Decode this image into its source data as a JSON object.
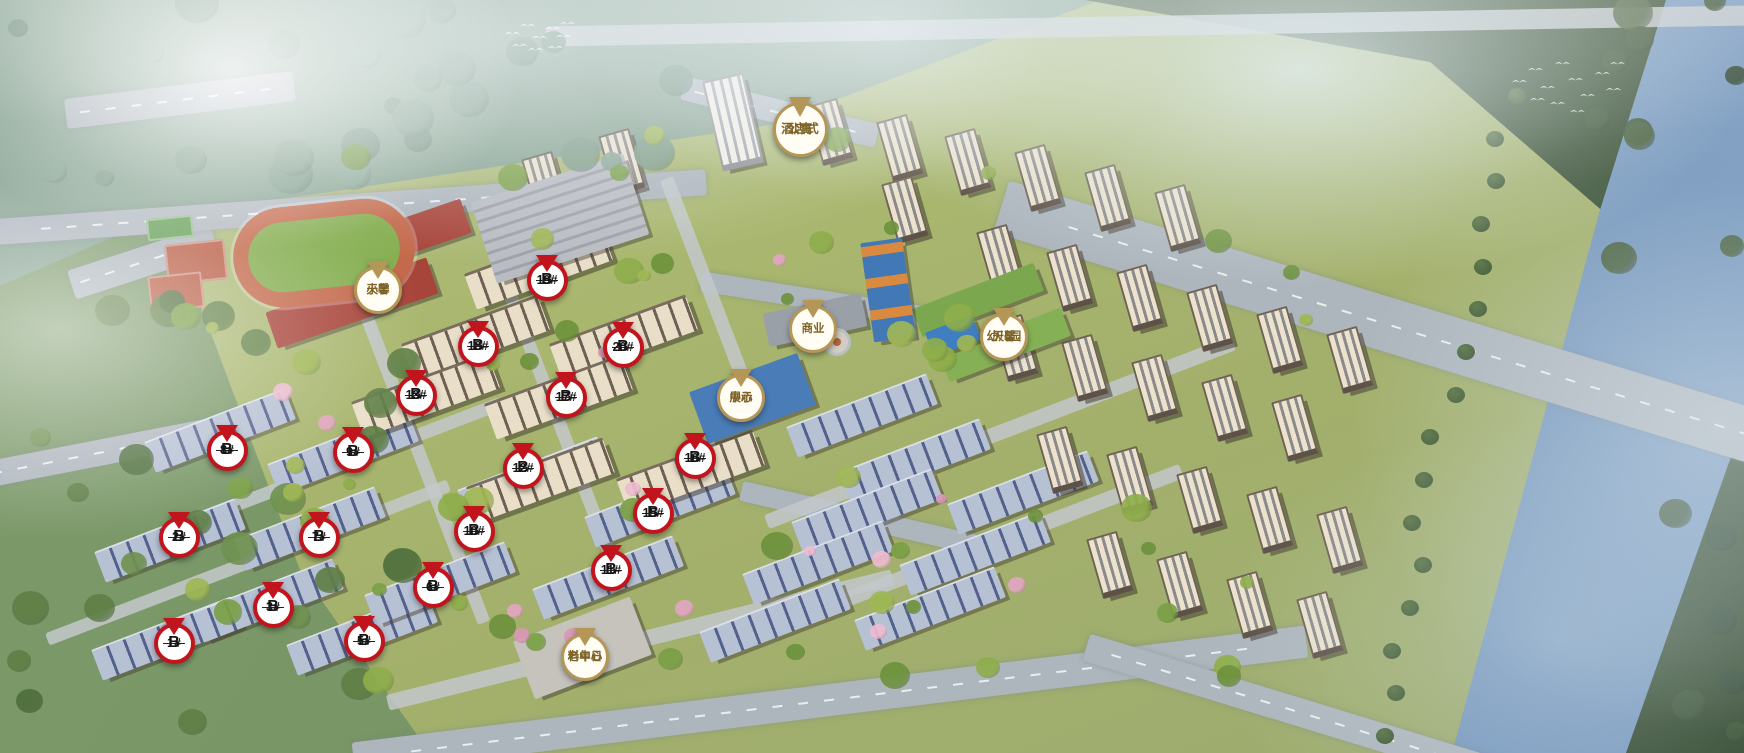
{
  "colors": {
    "pin_red": "#c1141d",
    "pin_gold": "#b49757",
    "pin_red_text": "#151515",
    "pin_gold_text": "#7d6327"
  },
  "pins": {
    "buildings": [
      {
        "slug": "b-1",
        "top": "B",
        "bottom": "1#",
        "x": 174,
        "y": 623
      },
      {
        "slug": "b-2",
        "top": "B",
        "bottom": "2#",
        "x": 179,
        "y": 517
      },
      {
        "slug": "b-3",
        "top": "B",
        "bottom": "3#",
        "x": 273,
        "y": 587
      },
      {
        "slug": "b-5",
        "top": "B",
        "bottom": "5#",
        "x": 364,
        "y": 621
      },
      {
        "slug": "b-6",
        "top": "B",
        "bottom": "6#",
        "x": 433,
        "y": 567
      },
      {
        "slug": "b-7",
        "top": "B",
        "bottom": "7#",
        "x": 319,
        "y": 517
      },
      {
        "slug": "b-8",
        "top": "B",
        "bottom": "8#",
        "x": 227,
        "y": 430
      },
      {
        "slug": "b-9",
        "top": "B",
        "bottom": "9#",
        "x": 353,
        "y": 432
      },
      {
        "slug": "b-10",
        "top": "B",
        "bottom": "10#",
        "x": 474,
        "y": 511
      },
      {
        "slug": "b-11",
        "top": "B",
        "bottom": "11#",
        "x": 611,
        "y": 550
      },
      {
        "slug": "b-12",
        "top": "B",
        "bottom": "12#",
        "x": 523,
        "y": 448
      },
      {
        "slug": "b-13",
        "top": "B",
        "bottom": "13#",
        "x": 416,
        "y": 375
      },
      {
        "slug": "b-15",
        "top": "B",
        "bottom": "15#",
        "x": 653,
        "y": 493
      },
      {
        "slug": "b-16",
        "top": "B",
        "bottom": "16#",
        "x": 695,
        "y": 438
      },
      {
        "slug": "b-17",
        "top": "B",
        "bottom": "17#",
        "x": 566,
        "y": 377
      },
      {
        "slug": "b-18",
        "top": "B",
        "bottom": "18#",
        "x": 478,
        "y": 326
      },
      {
        "slug": "b-19",
        "top": "B",
        "bottom": "19#",
        "x": 547,
        "y": 260
      },
      {
        "slug": "b-20",
        "top": "B",
        "bottom": "20#",
        "x": 623,
        "y": 327
      }
    ],
    "facilities": [
      {
        "slug": "hotel-apartment",
        "lines": [
          "酒店式",
          "公寓"
        ],
        "x": 800,
        "y": 102,
        "size": "lg"
      },
      {
        "slug": "commercial",
        "lines": [
          "商业"
        ],
        "x": 813,
        "y": 305,
        "size": "md"
      },
      {
        "slug": "exhibition-center",
        "lines": [
          "展示",
          "中心"
        ],
        "x": 741,
        "y": 374,
        "size": "md"
      },
      {
        "slug": "primary-school",
        "lines": [
          "天馨",
          "小学"
        ],
        "x": 378,
        "y": 266,
        "size": "md"
      },
      {
        "slug": "kindergarten",
        "lines": [
          "天馨",
          "幼儿园"
        ],
        "x": 1004,
        "y": 313,
        "size": "md"
      },
      {
        "slug": "elderly-day-care",
        "lines": [
          "老年日",
          "料中心"
        ],
        "x": 585,
        "y": 633,
        "size": "md"
      }
    ]
  }
}
